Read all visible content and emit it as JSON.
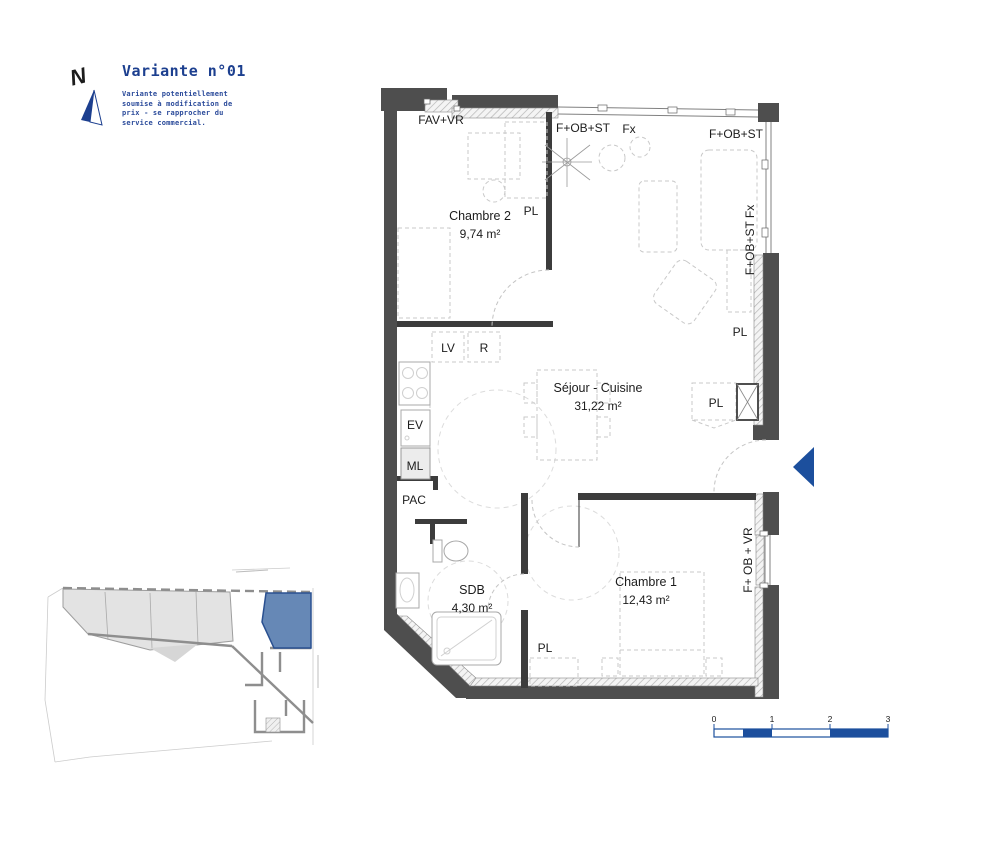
{
  "header": {
    "north_letter": "N",
    "title": "Variante n°01",
    "disclaimer": [
      "Variante potentiellement",
      "soumise à modification de",
      "prix - se rapprocher du",
      "service commercial."
    ]
  },
  "plan": {
    "rooms": {
      "chambre2": {
        "name": "Chambre 2",
        "area": "9,74 m²"
      },
      "sejour": {
        "name": "Séjour - Cuisine",
        "area": "31,22 m²"
      },
      "chambre1": {
        "name": "Chambre 1",
        "area": "12,43 m²"
      },
      "sdb": {
        "name": "SDB",
        "area": "4,30 m²"
      }
    },
    "openings": {
      "fav_vr": "FAV+VR",
      "fobst_top": "F+OB+ST",
      "fx_top": "Fx",
      "fobst_top_right": "F+OB+ST",
      "fobst_fx_right": "F+OB+ST Fx",
      "fob_vr_right": "F+ OB + VR"
    },
    "equipment": {
      "lv": "LV",
      "r": "R",
      "ev": "EV",
      "ml": "ML",
      "pac": "PAC",
      "pl_chambre2": "PL",
      "pl_wall": "PL",
      "pl_sejour": "PL",
      "pl_hall": "PL"
    }
  },
  "scale_bar": {
    "ticks": [
      "0",
      "1",
      "2",
      "3"
    ]
  },
  "colors": {
    "accent_blue": "#1c3f8f",
    "arrow_blue": "#1c4f9d",
    "keyplan_unit_fill": "#6688b6",
    "keyplan_unit_border": "#2a5090",
    "wall_dark": "#4e4e4e"
  }
}
